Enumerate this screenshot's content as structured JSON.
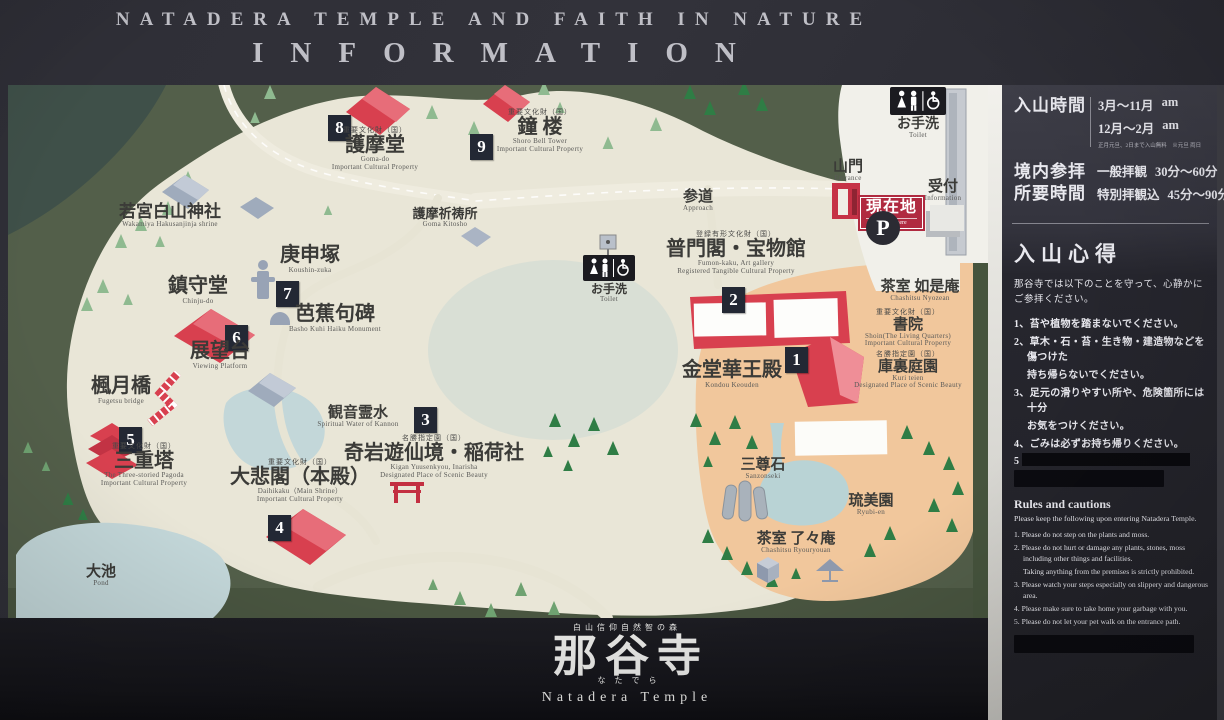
{
  "header": {
    "title_line1": "NATADERA TEMPLE AND FAITH IN NATURE",
    "title_line2": "INFORMATION"
  },
  "sidebar": {
    "hours_label": "入山時間",
    "hours_row1_period": "3月〜11月",
    "hours_row1_time": "am",
    "hours_row2_period": "12月〜2月",
    "hours_row2_time": "am",
    "hours_note": "正月元旦、2日まで入山無料　※元旦 両日",
    "duration_label1": "境内参拝",
    "duration_label2": "所要時間",
    "duration_row1_type": "一般拝観",
    "duration_row1_time": "30分〜60分",
    "duration_row2_type": "特別拝観込",
    "duration_row2_time": "45分〜90分",
    "precepts_title": "入山心得",
    "precepts_intro1": "那谷寺では以下のことを守って、心静かに",
    "precepts_intro2": "ご参拝ください。",
    "precepts_items": [
      "1、苔や植物を踏まないでください。",
      "2、草木・石・苔・生き物・建造物などを傷つけた",
      "持ち帰らないでください。",
      "3、足元の滑りやすい所や、危険箇所には十分",
      "お気をつけください。",
      "4、ごみは必ずお持ち帰りください。",
      "5"
    ],
    "rules_title": "Rules and cautions",
    "rules_intro": "Please keep the following upon entering Natadera Temple.",
    "rules_items": [
      "1. Please do not step on the plants and moss.",
      "2. Please do not hurt or damage any plants, stones, moss including other things and facilities.",
      "Taking anything from the premises is strictly prohibited.",
      "3. Please watch your steps especially on slippery and dangerous area.",
      "4. Please make sure to take home your garbage with you.",
      "5. Please do not let your pet walk on the entrance path."
    ]
  },
  "map": {
    "markers": [
      "1",
      "2",
      "3",
      "4",
      "5",
      "6",
      "7",
      "8",
      "9"
    ],
    "parking_label": "P",
    "labels": {
      "gomado": {
        "tag": "重要文化財（国）",
        "jp": "護摩堂",
        "en": "Goma-do",
        "en2": "Important Cultural Property"
      },
      "shoro": {
        "tag": "重要文化財（国）",
        "jp": "鐘 楼",
        "en": "Shoro Bell Tower",
        "en2": "Important Cultural Property"
      },
      "wakamiya": {
        "jp": "若宮白山神社",
        "en": "Wakamiya Hakusanjinja shrine"
      },
      "koushinzuka": {
        "jp": "庚申塚",
        "en": "Koushin-zuka"
      },
      "chinjudo": {
        "jp": "鎮守堂",
        "en": "Chinju-do"
      },
      "tenbodai": {
        "jp": "展望台",
        "en": "Viewing Platform"
      },
      "bashokuhi": {
        "jp": "芭蕉句碑",
        "en": "Basho Kuhi Haiku Monument"
      },
      "fugetsubashi": {
        "jp": "楓月橋",
        "en": "Fugetsu bridge"
      },
      "sanjunoto": {
        "tag": "重要文化財（国）",
        "jp": "三重塔",
        "en": "The Three-storied Pagoda",
        "en2": "Important Cultural Property"
      },
      "kannonreisui": {
        "jp": "観音霊水",
        "en": "Spiritual Water of Kannon"
      },
      "kiganyusenkyo": {
        "tag": "名勝指定園（国）",
        "jp": "奇岩遊仙境・稲荷社",
        "en": "Kigan Yuusenkyou, Inarisha",
        "en2": "Designated Place of Scenic Beauty"
      },
      "daihikaku": {
        "tag": "重要文化財（国）",
        "jp": "大悲閣（本殿）",
        "en": "Daihikaku（Main Shrine）",
        "en2": "Important Cultural Property"
      },
      "gomakitosho": {
        "jp": "護摩祈祷所",
        "en": "Goma Kitosho"
      },
      "sando": {
        "jp": "参道",
        "en": "Approach"
      },
      "fumonkaku": {
        "tag": "登録有形文化財（国）",
        "jp": "普門閣・宝物館",
        "en": "Fumon-kaku, Art gallery",
        "en2": "Registered Tangible Cultural Property"
      },
      "toilet_mid": {
        "jp": "お手洗",
        "en": "Toilet"
      },
      "toilet_top": {
        "jp": "お手洗",
        "en": "Toilet"
      },
      "sanmon": {
        "jp": "山門",
        "en": "Entrance"
      },
      "uketsuke": {
        "jp": "受付",
        "en": "Information"
      },
      "genzaichi": {
        "jp": "現在地",
        "en": "You are here"
      },
      "kondokeoden": {
        "jp": "金堂華王殿",
        "en": "Kondou Keouden"
      },
      "nyozean": {
        "jp": "茶室 如是庵",
        "en": "Chashitsu Nyozean"
      },
      "shoin": {
        "tag": "重要文化財（国）",
        "jp": "書院",
        "en": "Shoin(The Living Quarters)",
        "en2": "Important Cultural Property"
      },
      "kuriteien": {
        "tag": "名勝指定園（国）",
        "jp": "庫裏庭園",
        "en": "Kuri teien",
        "en2": "Designated Place of Scenic Beauty"
      },
      "sanzonseki": {
        "jp": "三尊石",
        "en": "Sanzonseki"
      },
      "ryubien": {
        "jp": "琉美園",
        "en": "Ryubi-en"
      },
      "ryoryoan": {
        "jp": "茶室 了々庵",
        "en": "Chashitsu Ryouryouan"
      },
      "oike": {
        "jp": "大池",
        "en": "Pond"
      }
    }
  },
  "footer": {
    "tagline": "白山信仰自然智の森",
    "temple_name": "那谷寺",
    "furigana": "なたでら",
    "temple_name_en": "Natadera Temple"
  },
  "colors": {
    "accent_red": "#d8404f",
    "marker_bg": "#232834",
    "you_are_here_red": "#b02a40",
    "map_ground": "#e9e6d7",
    "map_garden": "#f1c79c",
    "map_base_green": "#535f4a",
    "pond_blue": "#c3d7d9"
  }
}
